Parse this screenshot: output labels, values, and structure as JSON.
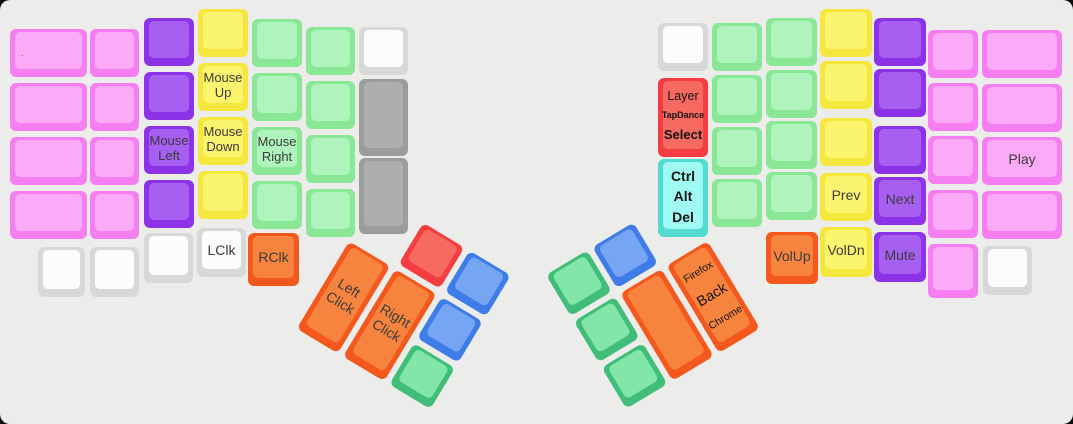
{
  "app": {
    "description": "Split ergonomic keyboard keymap layout view (mouse / media layer)",
    "background": "#ececeb",
    "page_background": "#0b0b0b"
  },
  "palette": {
    "pink": {
      "border": "#f57ef0",
      "top": "#fca9f7"
    },
    "purple": {
      "border": "#8c33e8",
      "top": "#a75ff2"
    },
    "yellow": {
      "border": "#f5e73e",
      "top": "#fbf46e"
    },
    "green": {
      "border": "#89e795",
      "top": "#aff4bd"
    },
    "white": {
      "border": "#d8d8d8",
      "top": "#fcfcfc"
    },
    "gray": {
      "border": "#9c9c9c",
      "top": "#aeaeae"
    },
    "red": {
      "border": "#f53c41",
      "top": "#f66a62"
    },
    "cyan": {
      "border": "#53dad1",
      "top": "#9efaf2"
    },
    "orange": {
      "border": "#f4581d",
      "top": "#f6843f"
    },
    "blue": {
      "border": "#3e7ce9",
      "top": "#76a5f3"
    },
    "tealgreen": {
      "border": "#40bd78",
      "top": "#81e6a8"
    }
  },
  "clusters": {
    "left": {
      "x": 377,
      "y": 195,
      "angle": 31
    },
    "right": {
      "x": 546,
      "y": 275,
      "angle": -31
    }
  },
  "keys": [
    {
      "n": "key-l-outer-1",
      "g": "main",
      "x": 10,
      "y": 29,
      "w": 77,
      "h": 48,
      "c": "pink",
      "dot": "."
    },
    {
      "n": "key-l-outer-2",
      "g": "main",
      "x": 10,
      "y": 83,
      "w": 77,
      "h": 48,
      "c": "pink"
    },
    {
      "n": "key-l-outer-3",
      "g": "main",
      "x": 10,
      "y": 137,
      "w": 77,
      "h": 48,
      "c": "pink"
    },
    {
      "n": "key-l-outer-4",
      "g": "main",
      "x": 10,
      "y": 191,
      "w": 77,
      "h": 48,
      "c": "pink"
    },
    {
      "n": "key-l-c2-1",
      "g": "main",
      "x": 90,
      "y": 29,
      "w": 49,
      "h": 48,
      "c": "pink"
    },
    {
      "n": "key-l-c2-2",
      "g": "main",
      "x": 90,
      "y": 83,
      "w": 49,
      "h": 48,
      "c": "pink"
    },
    {
      "n": "key-l-c2-3",
      "g": "main",
      "x": 90,
      "y": 137,
      "w": 49,
      "h": 48,
      "c": "pink"
    },
    {
      "n": "key-l-c2-4",
      "g": "main",
      "x": 90,
      "y": 191,
      "w": 49,
      "h": 48,
      "c": "pink"
    },
    {
      "n": "key-l-c3-1",
      "g": "main",
      "x": 144,
      "y": 18,
      "w": 50,
      "h": 48,
      "c": "purple"
    },
    {
      "n": "key-l-c3-2",
      "g": "main",
      "x": 144,
      "y": 72,
      "w": 50,
      "h": 48,
      "c": "purple"
    },
    {
      "n": "key-mouse-left",
      "g": "main",
      "x": 144,
      "y": 126,
      "w": 50,
      "h": 48,
      "c": "purple",
      "t": "Mouse\nLeft"
    },
    {
      "n": "key-l-c3-4",
      "g": "main",
      "x": 144,
      "y": 180,
      "w": 50,
      "h": 48,
      "c": "purple"
    },
    {
      "n": "key-l-c4-1",
      "g": "main",
      "x": 198,
      "y": 9,
      "w": 50,
      "h": 48,
      "c": "yellow"
    },
    {
      "n": "key-mouse-up",
      "g": "main",
      "x": 198,
      "y": 63,
      "w": 50,
      "h": 48,
      "c": "yellow",
      "t": "Mouse\nUp"
    },
    {
      "n": "key-mouse-down",
      "g": "main",
      "x": 198,
      "y": 117,
      "w": 50,
      "h": 48,
      "c": "yellow",
      "t": "Mouse\nDown"
    },
    {
      "n": "key-l-c4-4",
      "g": "main",
      "x": 198,
      "y": 171,
      "w": 50,
      "h": 48,
      "c": "yellow"
    },
    {
      "n": "key-l-c5-1",
      "g": "main",
      "x": 252,
      "y": 19,
      "w": 50,
      "h": 48,
      "c": "green"
    },
    {
      "n": "key-l-c5-2",
      "g": "main",
      "x": 252,
      "y": 73,
      "w": 50,
      "h": 48,
      "c": "green"
    },
    {
      "n": "key-mouse-right",
      "g": "main",
      "x": 252,
      "y": 127,
      "w": 50,
      "h": 48,
      "c": "green",
      "t": "Mouse\nRight"
    },
    {
      "n": "key-l-c5-4",
      "g": "main",
      "x": 252,
      "y": 181,
      "w": 50,
      "h": 48,
      "c": "green"
    },
    {
      "n": "key-l-c6-1",
      "g": "main",
      "x": 306,
      "y": 27,
      "w": 49,
      "h": 48,
      "c": "green"
    },
    {
      "n": "key-l-c6-2",
      "g": "main",
      "x": 306,
      "y": 81,
      "w": 49,
      "h": 48,
      "c": "green"
    },
    {
      "n": "key-l-c6-3",
      "g": "main",
      "x": 306,
      "y": 135,
      "w": 49,
      "h": 48,
      "c": "green"
    },
    {
      "n": "key-l-c6-4",
      "g": "main",
      "x": 306,
      "y": 189,
      "w": 49,
      "h": 48,
      "c": "green"
    },
    {
      "n": "key-l-c7-1",
      "g": "main",
      "x": 359,
      "y": 27,
      "w": 49,
      "h": 48,
      "c": "white"
    },
    {
      "n": "key-l-c7-2",
      "g": "main",
      "x": 359,
      "y": 79,
      "w": 49,
      "h": 77,
      "c": "gray"
    },
    {
      "n": "key-l-c7-3",
      "g": "main",
      "x": 359,
      "y": 158,
      "w": 49,
      "h": 76,
      "c": "gray"
    },
    {
      "n": "key-l-bottom-1",
      "g": "main",
      "x": 38,
      "y": 247,
      "w": 47,
      "h": 50,
      "c": "white"
    },
    {
      "n": "key-l-bottom-2",
      "g": "main",
      "x": 90,
      "y": 247,
      "w": 49,
      "h": 50,
      "c": "white"
    },
    {
      "n": "key-l-bottom-3",
      "g": "main",
      "x": 144,
      "y": 233,
      "w": 49,
      "h": 50,
      "c": "white"
    },
    {
      "n": "key-lclk",
      "g": "main",
      "x": 197,
      "y": 228,
      "w": 49,
      "h": 49,
      "c": "white",
      "t": "LClk",
      "s": 14
    },
    {
      "n": "key-rclk",
      "g": "main",
      "x": 248,
      "y": 233,
      "w": 51,
      "h": 53,
      "c": "orange",
      "t": "RClk",
      "s": 14
    },
    {
      "n": "key-left-click",
      "g": "left",
      "x": 0,
      "y": 54,
      "w": 48,
      "h": 102,
      "c": "orange",
      "t": "Left\nClick",
      "s": 14
    },
    {
      "n": "key-right-click",
      "g": "left",
      "x": 54,
      "y": 54,
      "w": 48,
      "h": 102,
      "c": "orange",
      "t": "Right\nClick",
      "s": 14
    },
    {
      "n": "key-lcluster-red",
      "g": "left",
      "x": 54,
      "y": 0,
      "w": 48,
      "h": 48,
      "c": "red"
    },
    {
      "n": "key-lcluster-blue-1",
      "g": "left",
      "x": 108,
      "y": 0,
      "w": 48,
      "h": 48,
      "c": "blue"
    },
    {
      "n": "key-lcluster-blue-2",
      "g": "left",
      "x": 108,
      "y": 54,
      "w": 48,
      "h": 48,
      "c": "blue"
    },
    {
      "n": "key-lcluster-green",
      "g": "left",
      "x": 108,
      "y": 108,
      "w": 48,
      "h": 48,
      "c": "tealgreen"
    },
    {
      "n": "key-rcluster-green-1",
      "g": "right",
      "x": 0,
      "y": 0,
      "w": 48,
      "h": 48,
      "c": "tealgreen"
    },
    {
      "n": "key-rcluster-green-2",
      "g": "right",
      "x": 0,
      "y": 54,
      "w": 48,
      "h": 48,
      "c": "tealgreen"
    },
    {
      "n": "key-rcluster-green-3",
      "g": "right",
      "x": 0,
      "y": 108,
      "w": 48,
      "h": 48,
      "c": "tealgreen"
    },
    {
      "n": "key-rcluster-blue",
      "g": "right",
      "x": 54,
      "y": 0,
      "w": 48,
      "h": 48,
      "c": "blue"
    },
    {
      "n": "key-rcluster-orange",
      "g": "right",
      "x": 54,
      "y": 54,
      "w": 48,
      "h": 102,
      "c": "orange"
    },
    {
      "n": "key-back",
      "g": "right",
      "x": 108,
      "y": 54,
      "w": 48,
      "h": 102,
      "c": "orange",
      "lines": [
        {
          "t": "Firefox",
          "s": 10.5
        },
        {
          "t": "Back",
          "s": 14.5
        },
        {
          "t": "Chrome",
          "s": 10.5
        }
      ]
    },
    {
      "n": "key-r-c7-1",
      "g": "main",
      "x": 658,
      "y": 23,
      "w": 50,
      "h": 48,
      "c": "white"
    },
    {
      "n": "key-layer-tapdance-select",
      "g": "main",
      "x": 658,
      "y": 78,
      "w": 50,
      "h": 79,
      "c": "red",
      "lines": [
        {
          "t": "Layer",
          "s": 12.5
        },
        {
          "t": "TapDance",
          "s": 9,
          "b": 1
        },
        {
          "t": "Select",
          "s": 13,
          "b": 1
        }
      ]
    },
    {
      "n": "key-ctrl-alt-del",
      "g": "main",
      "x": 658,
      "y": 159,
      "w": 50,
      "h": 78,
      "c": "cyan",
      "lines": [
        {
          "t": "Ctrl",
          "s": 14,
          "b": 1
        },
        {
          "t": "Alt",
          "s": 14,
          "b": 1
        },
        {
          "t": "Del",
          "s": 14,
          "b": 1
        }
      ]
    },
    {
      "n": "key-r-c6-1",
      "g": "main",
      "x": 712,
      "y": 23,
      "w": 50,
      "h": 48,
      "c": "green"
    },
    {
      "n": "key-r-c6-2",
      "g": "main",
      "x": 712,
      "y": 75,
      "w": 50,
      "h": 48,
      "c": "green"
    },
    {
      "n": "key-r-c6-3",
      "g": "main",
      "x": 712,
      "y": 127,
      "w": 50,
      "h": 48,
      "c": "green"
    },
    {
      "n": "key-r-c6-4",
      "g": "main",
      "x": 712,
      "y": 179,
      "w": 50,
      "h": 48,
      "c": "green"
    },
    {
      "n": "key-r-c5-1",
      "g": "main",
      "x": 766,
      "y": 18,
      "w": 51,
      "h": 48,
      "c": "green"
    },
    {
      "n": "key-r-c5-2",
      "g": "main",
      "x": 766,
      "y": 70,
      "w": 51,
      "h": 48,
      "c": "green"
    },
    {
      "n": "key-r-c5-3",
      "g": "main",
      "x": 766,
      "y": 121,
      "w": 51,
      "h": 48,
      "c": "green"
    },
    {
      "n": "key-r-c5-4",
      "g": "main",
      "x": 766,
      "y": 172,
      "w": 51,
      "h": 48,
      "c": "green"
    },
    {
      "n": "key-volup",
      "g": "main",
      "x": 766,
      "y": 232,
      "w": 52,
      "h": 52,
      "c": "orange",
      "t": "VolUp",
      "s": 14
    },
    {
      "n": "key-r-c4-1",
      "g": "main",
      "x": 820,
      "y": 9,
      "w": 52,
      "h": 48,
      "c": "yellow"
    },
    {
      "n": "key-r-c4-2",
      "g": "main",
      "x": 820,
      "y": 61,
      "w": 52,
      "h": 48,
      "c": "yellow"
    },
    {
      "n": "key-r-c4-3",
      "g": "main",
      "x": 820,
      "y": 118,
      "w": 52,
      "h": 48,
      "c": "yellow"
    },
    {
      "n": "key-prev",
      "g": "main",
      "x": 820,
      "y": 173,
      "w": 52,
      "h": 48,
      "c": "yellow",
      "t": "Prev",
      "s": 14
    },
    {
      "n": "key-voldn",
      "g": "main",
      "x": 820,
      "y": 227,
      "w": 52,
      "h": 50,
      "c": "yellow",
      "t": "VolDn",
      "s": 14
    },
    {
      "n": "key-r-c3-1",
      "g": "main",
      "x": 874,
      "y": 18,
      "w": 52,
      "h": 48,
      "c": "purple"
    },
    {
      "n": "key-r-c3-2",
      "g": "main",
      "x": 874,
      "y": 69,
      "w": 52,
      "h": 48,
      "c": "purple"
    },
    {
      "n": "key-r-c3-3",
      "g": "main",
      "x": 874,
      "y": 126,
      "w": 52,
      "h": 48,
      "c": "purple"
    },
    {
      "n": "key-next",
      "g": "main",
      "x": 874,
      "y": 177,
      "w": 52,
      "h": 48,
      "c": "purple",
      "t": "Next",
      "s": 14
    },
    {
      "n": "key-mute",
      "g": "main",
      "x": 874,
      "y": 232,
      "w": 52,
      "h": 50,
      "c": "purple",
      "t": "Mute",
      "s": 14
    },
    {
      "n": "key-r-c2-1",
      "g": "main",
      "x": 928,
      "y": 30,
      "w": 50,
      "h": 48,
      "c": "pink"
    },
    {
      "n": "key-r-c2-2",
      "g": "main",
      "x": 928,
      "y": 83,
      "w": 50,
      "h": 48,
      "c": "pink"
    },
    {
      "n": "key-r-c2-3",
      "g": "main",
      "x": 928,
      "y": 136,
      "w": 50,
      "h": 48,
      "c": "pink"
    },
    {
      "n": "key-r-c2-4",
      "g": "main",
      "x": 928,
      "y": 190,
      "w": 50,
      "h": 48,
      "c": "pink"
    },
    {
      "n": "key-r-bottom-pink",
      "g": "main",
      "x": 928,
      "y": 244,
      "w": 50,
      "h": 54,
      "c": "pink"
    },
    {
      "n": "key-r-outer-1",
      "g": "main",
      "x": 982,
      "y": 30,
      "w": 80,
      "h": 48,
      "c": "pink"
    },
    {
      "n": "key-r-outer-2",
      "g": "main",
      "x": 982,
      "y": 84,
      "w": 80,
      "h": 48,
      "c": "pink"
    },
    {
      "n": "key-play",
      "g": "main",
      "x": 982,
      "y": 137,
      "w": 80,
      "h": 48,
      "c": "pink",
      "t": "Play",
      "s": 14
    },
    {
      "n": "key-r-outer-4",
      "g": "main",
      "x": 982,
      "y": 191,
      "w": 80,
      "h": 48,
      "c": "pink"
    },
    {
      "n": "key-r-bottom-white",
      "g": "main",
      "x": 983,
      "y": 246,
      "w": 49,
      "h": 49,
      "c": "white"
    }
  ]
}
